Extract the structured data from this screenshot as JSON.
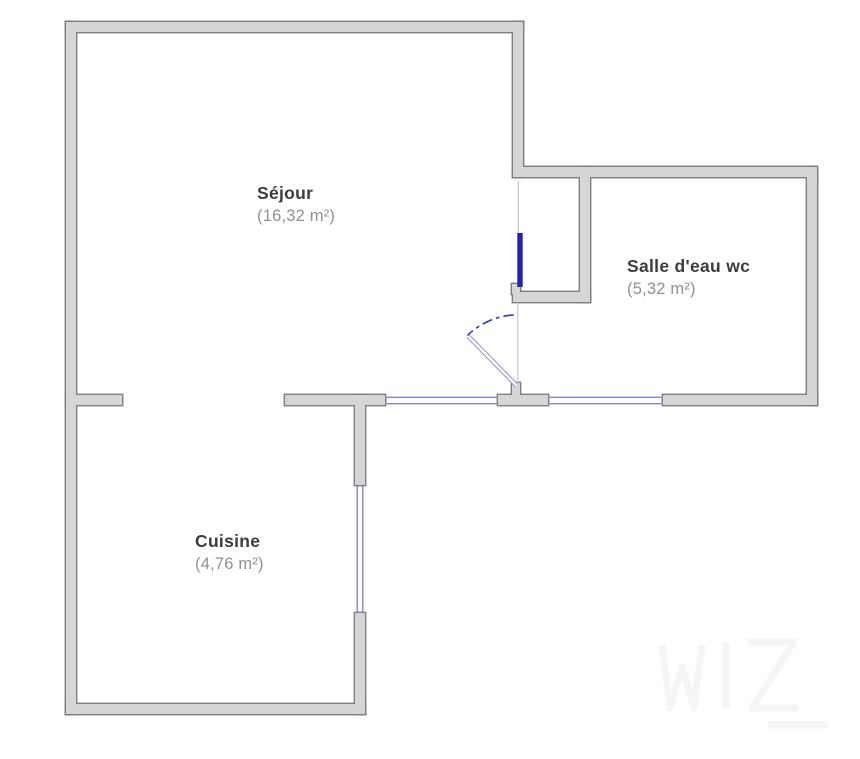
{
  "rooms": [
    {
      "id": "sejour",
      "name": "Séjour",
      "area": "(16,32 m²)"
    },
    {
      "id": "salle-eau",
      "name": "Salle d'eau wc",
      "area": "(5,32 m²)"
    },
    {
      "id": "cuisine",
      "name": "Cuisine",
      "area": "(4,76 m²)"
    }
  ],
  "icons": {
    "watermark": "watermark-logo"
  },
  "colors": {
    "background": "#ffffff",
    "wall_fill": "#d6d6d6",
    "wall_stroke": "#7e7e7e",
    "window_line": "#8585c9",
    "door_panel": "#2222b2",
    "door_swing": "#3d3dc4",
    "door_leaf": "#9a9ad2",
    "opening_line": "#c2c2c2",
    "room_name_color": "#3c3c3c",
    "room_area_color": "#929292"
  }
}
